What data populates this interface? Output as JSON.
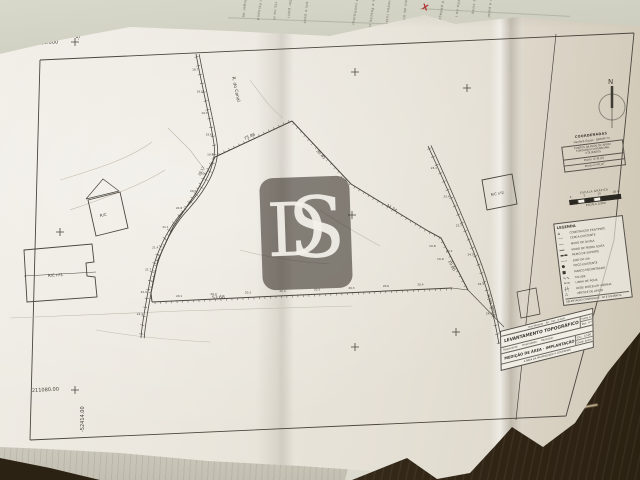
{
  "background": {
    "red_mark": "X",
    "top_fragments": [
      {
        "t": "o lugar de",
        "x": 248,
        "y": -4,
        "r": 97
      },
      {
        "t": "el Fernand",
        "x": 263,
        "y": -2,
        "r": 98
      },
      {
        "t": "rto na m",
        "x": 278,
        "y": 2,
        "r": 96
      },
      {
        "t": "ador patri",
        "x": 293,
        "y": -3,
        "r": 97
      },
      {
        "t": "em e poss",
        "x": 309,
        "y": 2,
        "r": 96
      },
      {
        "t": "s, a confrontar",
        "x": 360,
        "y": -6,
        "r": 99
      },
      {
        "t": "te e Poente co",
        "x": 376,
        "y": -2,
        "r": 98
      },
      {
        "t": "veredas rusti",
        "x": 392,
        "y": -4,
        "r": 97
      },
      {
        "t": "mil de oito e",
        "x": 408,
        "y": 0,
        "r": 96
      },
      {
        "t": "m e pedaço",
        "x": 446,
        "y": -4,
        "r": 100
      },
      {
        "t": "sito no l",
        "x": 461,
        "y": 0,
        "r": 99
      },
      {
        "t": "de vinte",
        "x": 477,
        "y": -3,
        "r": 98
      },
      {
        "t": "e a poial",
        "x": 493,
        "y": -1,
        "r": 97
      }
    ],
    "bottom_fragments": [
      {
        "t": "morada e conf",
        "x": 366,
        "y": 434,
        "r": -78
      },
      {
        "t": "ASSUNTO:",
        "x": 382,
        "y": 446,
        "r": -77
      },
      {
        "t": "Lista de serv",
        "x": 395,
        "y": 436,
        "r": -78
      },
      {
        "t": "no dia util",
        "x": 409,
        "y": 448,
        "r": -76
      }
    ]
  },
  "sheet": {
    "watermark": {
      "letter_d": "D",
      "letter_s": "S"
    },
    "notes": {
      "title": "COORDENADAS",
      "datum": "Hayford-Gauss · DATUM 73",
      "box": [
        "PONTOS DA REDE DE APOIO",
        "TOPOGRÁFICO MUNICIPAL",
        "UTILIZADOS"
      ],
      "points": [
        "Ponto nº M_05",
        "Ponto nº M_07"
      ]
    },
    "scale": {
      "title": "ESCALA GRÁFICA",
      "tick_labels": [
        "0",
        "5",
        "10",
        "20 m"
      ],
      "ratio": "ESCALA 1/500"
    },
    "legend": {
      "title": "LEGENDA",
      "items": [
        {
          "sym": "⌂",
          "label": "CONSTRUÇÃO EXISTENTE"
        },
        {
          "sym": "╌╌",
          "label": "CERCA EXISTENTE"
        },
        {
          "sym": "──",
          "label": "MURO DE DIVISA"
        },
        {
          "sym": "══",
          "label": "MURO DE PEDRA SOLTA"
        },
        {
          "sym": "▬▬",
          "label": "MURO DE SUPORTE"
        },
        {
          "sym": "─·─",
          "label": "EIXO DA VIA"
        },
        {
          "sym": "●",
          "label": "POÇO EXISTENTE"
        },
        {
          "sym": "■",
          "label": "MARCO ENCONTRADO"
        },
        {
          "sym": "∿∿",
          "label": "TALUDE"
        },
        {
          "sym": "≈≈",
          "label": "LINHA DE ÁGUA"
        },
        {
          "sym": "┼┼",
          "label": "REDE PARCELAR VIZINHA"
        },
        {
          "sym": "△",
          "label": "VÉRTICE DE APOIO"
        }
      ],
      "footer": "DELIMITAÇÃO CONFINANTE · Nº E DISTÂNCIA"
    },
    "title_block": {
      "contact": "Rua Miramar · Tel. · Fax · e-mail",
      "doc_title": "LEVANTAMENTO TOPOGRÁFICO",
      "folha_label": "Folha",
      "folha": "1/1",
      "desenho_label": "Des. nº",
      "desenho": "01",
      "req_label": "Requerente:",
      "prop_label": "Propriedade:",
      "mun_label": "Município:",
      "subtitle": "MEDIÇÃO DE ÁREA · IMPLANTAÇÃO",
      "escala_label": "Esc.:",
      "escala": "1/500",
      "data_label": "Data:",
      "data": "Junho",
      "footer": "A ÁREA DA PROPRIEDADE A CONFIRMAR"
    },
    "drawing": {
      "labels": [
        {
          "t": "211180.000",
          "x": 28,
          "y": 45,
          "s": 5,
          "r": -3
        },
        {
          "t": "-52414.000",
          "x": 80,
          "y": 40,
          "s": 5,
          "r": -90
        },
        {
          "t": "211080.00",
          "x": 32,
          "y": 392,
          "s": 5,
          "r": -3
        },
        {
          "t": "-52414.00",
          "x": 84,
          "y": 432,
          "s": 5,
          "r": -90
        },
        {
          "t": "N",
          "x": 608,
          "y": 84,
          "s": 7,
          "r": 0
        },
        {
          "t": "R. do Canal",
          "x": 232,
          "y": 77,
          "s": 4.5,
          "r": 78
        },
        {
          "t": "R. da Presa",
          "x": 487,
          "y": 295,
          "s": 4,
          "r": 72
        },
        {
          "t": "R/C",
          "x": 100,
          "y": 217,
          "s": 4,
          "r": -10
        },
        {
          "t": "R/C nº1",
          "x": 48,
          "y": 277,
          "s": 4,
          "r": -4
        },
        {
          "t": "R/C nº2",
          "x": 491,
          "y": 196,
          "s": 3.5,
          "r": -10
        },
        {
          "t": "75.86",
          "x": 245,
          "y": 140,
          "s": 4,
          "r": -25
        },
        {
          "t": "30.45",
          "x": 316,
          "y": 151,
          "s": 4,
          "r": 47
        },
        {
          "t": "34.24",
          "x": 386,
          "y": 206,
          "s": 4,
          "r": 31
        },
        {
          "t": "19.80",
          "x": 448,
          "y": 261,
          "s": 4,
          "r": 62
        },
        {
          "t": "28.17",
          "x": 200,
          "y": 176,
          "s": 3.5,
          "r": -62
        },
        {
          "t": "53.68",
          "x": 212,
          "y": 299,
          "s": 4.5,
          "r": -2
        },
        {
          "t": "19.8",
          "x": 429,
          "y": 247,
          "s": 3,
          "r": 0
        },
        {
          "t": "20.1",
          "x": 446,
          "y": 252,
          "s": 3,
          "r": 0
        },
        {
          "t": "19.9",
          "x": 437,
          "y": 260,
          "s": 3,
          "r": 0
        }
      ],
      "road1_numbers": [
        "18.7",
        "19.0",
        "19.3",
        "19.6",
        "19.9",
        "20.2",
        "20.5",
        "20.8",
        "21.1",
        "21.4",
        "21.7",
        "22.0",
        "22.3"
      ],
      "road2_numbers": [
        "23.1",
        "23.4",
        "23.7",
        "24.0",
        "24.3",
        "24.6"
      ],
      "boundary_numbers": [
        "20.1",
        "20.3",
        "20.2",
        "20.4",
        "20.5",
        "20.3",
        "20.6",
        "20.4"
      ]
    }
  }
}
